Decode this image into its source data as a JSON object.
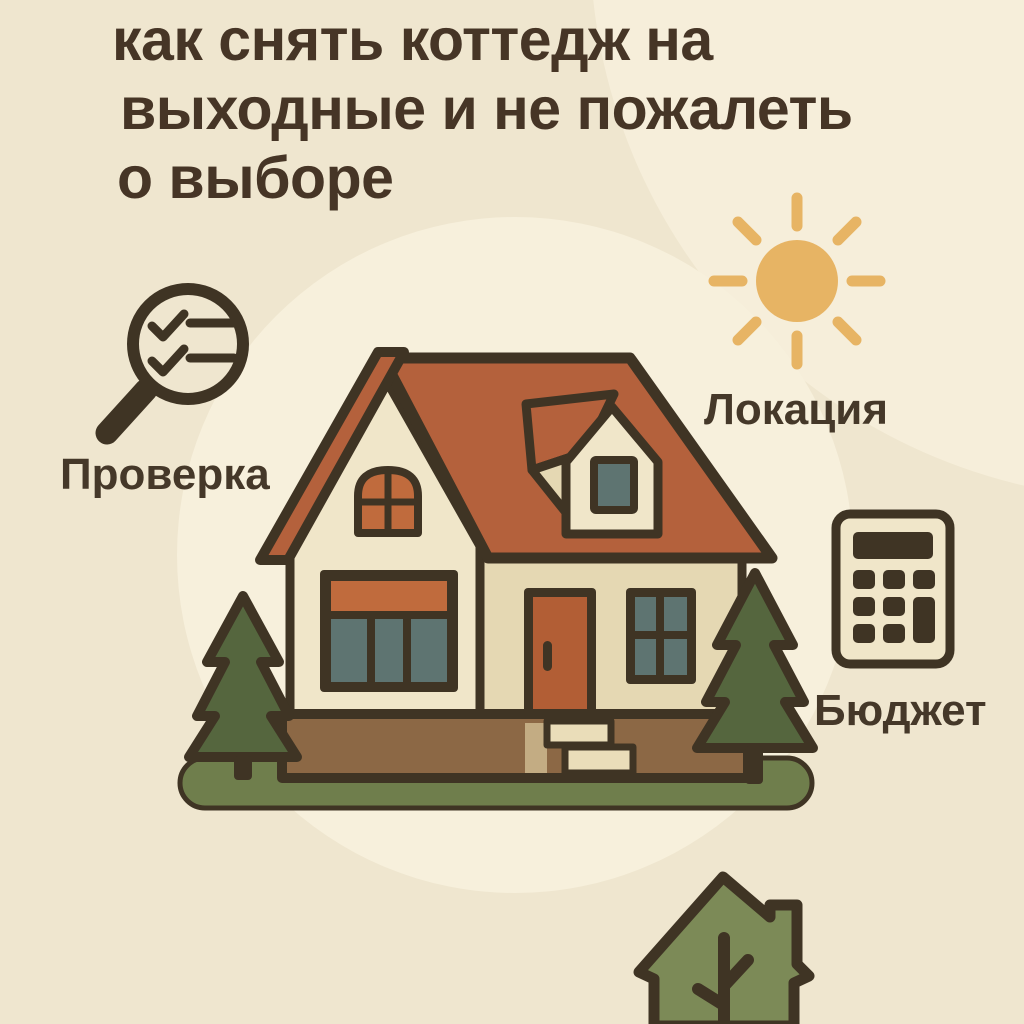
{
  "title": {
    "lines": [
      "как снять коттедж на",
      "выходные и не пожалеть",
      "о выборе"
    ]
  },
  "sections": {
    "check": {
      "label": "Проверка",
      "icon": "magnifier-checklist-icon"
    },
    "location": {
      "label": "Локация",
      "icon": "sun-icon"
    },
    "budget": {
      "label": "Бюджет",
      "icon": "calculator-icon"
    }
  },
  "footer": {
    "icon": "eco-house-tree-icon"
  },
  "illustration": {
    "subject": "cottage-with-pine-trees"
  },
  "palette": {
    "bg": "#EFE6CF",
    "bg_light": "#F7F0DC",
    "ink": "#3F3424",
    "title_ink": "#463526",
    "label_ink": "#453829",
    "amber": "#E7B464",
    "roof": "#B4613C",
    "accent_rust": "#C06B3D",
    "wall": "#E5D8B3",
    "wall_light": "#F0E6C9",
    "glass": "#5E7471",
    "door": "#B25E35",
    "foundation": "#8C6845",
    "foundation_light": "#C3AC83",
    "step": "#EADDB9",
    "grass": "#6F7E4C",
    "tree": "#55663E",
    "eco_house": "#7C8A57"
  }
}
